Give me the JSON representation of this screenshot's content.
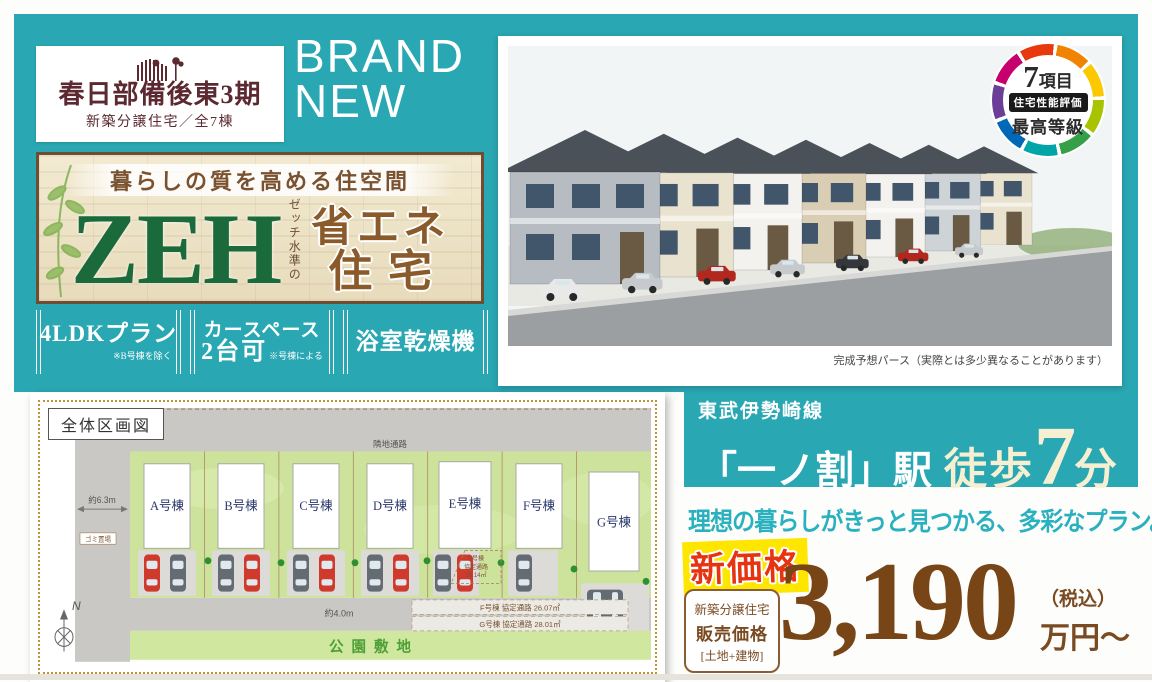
{
  "logo": {
    "title": "春日部備後東3期",
    "subtitle": "新築分譲住宅／全7棟"
  },
  "brand_new": {
    "line1": "BRAND",
    "line2": "NEW"
  },
  "zeh": {
    "tagline": "暮らしの質を高める住空間",
    "word": "ZEH",
    "ruby": "ゼッチ水準の",
    "sub_line1": "省エネ",
    "sub_line2": "住宅"
  },
  "features": [
    {
      "label": "4LDKプラン",
      "note": "※B号棟を除く"
    },
    {
      "label": "カースペース",
      "label2": "2台可",
      "note": "※号棟による"
    },
    {
      "label": "浴室乾燥機",
      "note": ""
    }
  ],
  "award": {
    "count": "7",
    "count_unit": "項目",
    "box_label": "住宅性能評価",
    "grade": "最高等級"
  },
  "photo": {
    "caption": "完成予想パース（実際とは多少異なることがあります）"
  },
  "access": {
    "railway": "東武伊勢崎線",
    "station": "「一ノ割」駅",
    "walk": "徒歩",
    "minutes": "7",
    "minutes_unit": "分"
  },
  "catchcopy": "理想の暮らしがきっと見つかる、多彩なプラン。",
  "price": {
    "badge": "新価格",
    "category": "新築分譲住宅",
    "label": "販売価格",
    "scope": "[土地+建物]",
    "amount": "3,190",
    "tax_note": "（税込）",
    "unit": "万円〜"
  },
  "siteplan": {
    "title": "全体区画図",
    "neighbor_label": "隣地通路",
    "buildings": [
      "A号棟",
      "B号棟",
      "C号棟",
      "D号棟",
      "E号棟",
      "F号棟",
      "G号棟"
    ],
    "dim_west": "約6.3m",
    "dim_road": "約4.0m",
    "trash_label": "ゴミ置場",
    "park_label": "公園敷地",
    "compass_label": "N",
    "note_e": {
      "name": "E号棟",
      "label": "協定通路",
      "area": "19.14㎡"
    },
    "note_f": "F号棟 協定通路 26.07㎡",
    "note_g": "G号棟 協定通路 28.01㎡"
  },
  "colors": {
    "teal": "#29a7b3",
    "cream": "#f7efd2",
    "price_brown": "#774516",
    "accent_red": "#e63312",
    "highlight_yellow": "#ffe600",
    "zeh_green": "#1a6a3c"
  }
}
